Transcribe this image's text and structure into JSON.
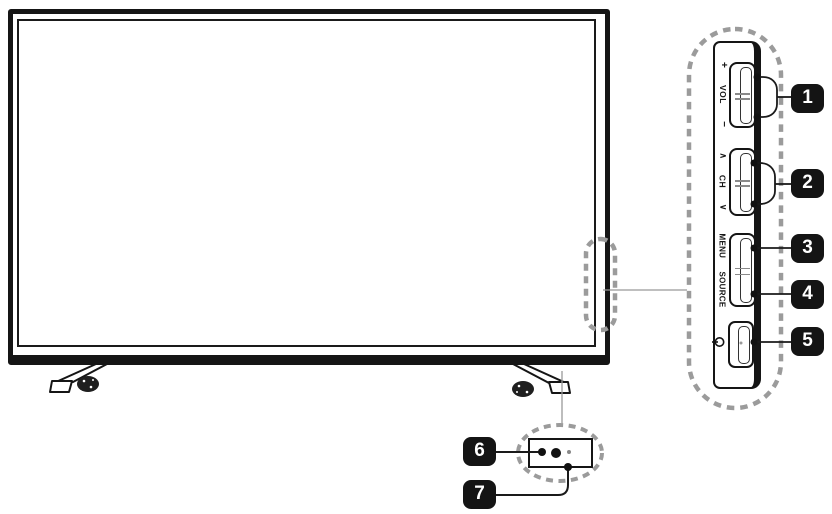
{
  "panel": {
    "volume": {
      "plus": "+",
      "label": "VOL",
      "minus": "−"
    },
    "channel": {
      "up": "∧",
      "label": "CH",
      "down": "∨"
    },
    "menu": "MENU",
    "source": "SOURCE",
    "power_icon": "power-symbol"
  },
  "callouts": [
    {
      "number": "1",
      "points_to": "volume-rocker"
    },
    {
      "number": "2",
      "points_to": "channel-rocker"
    },
    {
      "number": "3",
      "points_to": "menu-button"
    },
    {
      "number": "4",
      "points_to": "source-button"
    },
    {
      "number": "5",
      "points_to": "power-button"
    },
    {
      "number": "6",
      "points_to": "ir-sensor"
    },
    {
      "number": "7",
      "points_to": "power-indicator"
    }
  ],
  "colors": {
    "line": "#1a1a1a",
    "dash": "#9b9b9b",
    "badge_bg": "#141414",
    "badge_text": "#ffffff",
    "background": "#ffffff"
  }
}
